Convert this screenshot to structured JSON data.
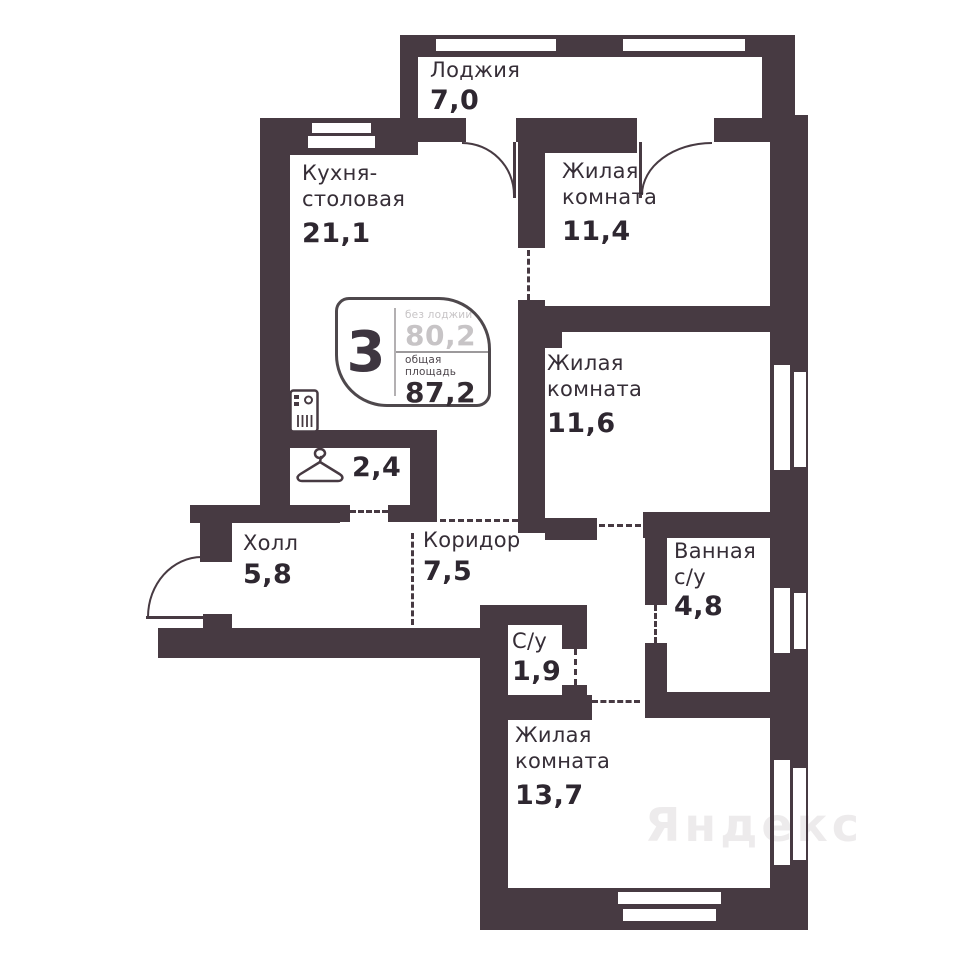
{
  "plan": {
    "badge": {
      "rooms_count": "3",
      "top_label": "без лоджии",
      "top_value": "80,2",
      "bottom_label": "общая площадь",
      "bottom_value": "87,2"
    },
    "rooms": {
      "loggia": {
        "name": "Лоджия",
        "area": "7,0"
      },
      "kitchen": {
        "line1": "Кухня-",
        "line2": "столовая",
        "area": "21,1"
      },
      "bedroom_top": {
        "line1": "Жилая",
        "line2": "комната",
        "area": "11,4"
      },
      "bedroom_mid": {
        "line1": "Жилая",
        "line2": "комната",
        "area": "11,6"
      },
      "wardrobe": {
        "area": "2,4"
      },
      "hall": {
        "name": "Холл",
        "area": "5,8"
      },
      "corridor": {
        "name": "Коридор",
        "area": "7,5"
      },
      "wc": {
        "name": "С/у",
        "area": "1,9"
      },
      "bathroom": {
        "line1": "Ванная",
        "line2": "с/у",
        "area": "4,8"
      },
      "bedroom_bottom": {
        "line1": "Жилая",
        "line2": "комната",
        "area": "13,7"
      }
    },
    "watermark": "Яндекс",
    "colors": {
      "wall": "#473A42",
      "text": "#352D36",
      "badge_muted": "#C6C6C6"
    },
    "icons": {
      "sink": "sink-icon",
      "hanger": "hanger-icon"
    }
  }
}
